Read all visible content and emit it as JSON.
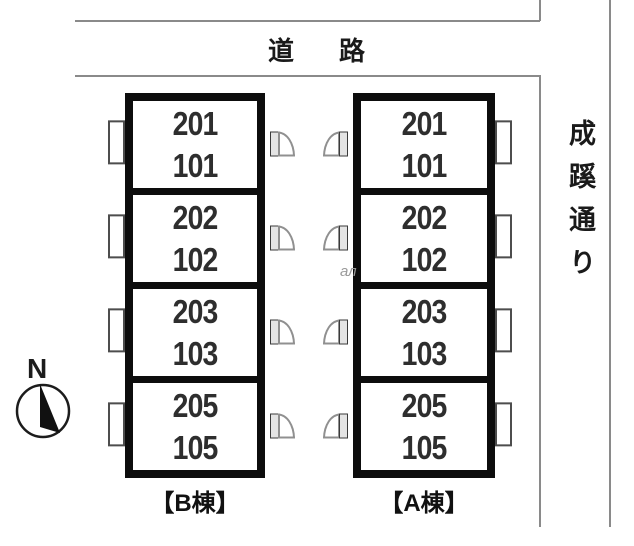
{
  "road": {
    "label": "道路"
  },
  "street": {
    "label": "成蹊通り"
  },
  "compass": {
    "label": "N"
  },
  "watermark": {
    "text": "ал"
  },
  "buildings": [
    {
      "id": "B",
      "label": "【B棟】",
      "door_side": "right",
      "units": [
        {
          "upper": "201",
          "lower": "101"
        },
        {
          "upper": "202",
          "lower": "102"
        },
        {
          "upper": "203",
          "lower": "103"
        },
        {
          "upper": "205",
          "lower": "105"
        }
      ]
    },
    {
      "id": "A",
      "label": "【A棟】",
      "door_side": "left",
      "units": [
        {
          "upper": "201",
          "lower": "101"
        },
        {
          "upper": "202",
          "lower": "102"
        },
        {
          "upper": "203",
          "lower": "103"
        },
        {
          "upper": "205",
          "lower": "105"
        }
      ]
    }
  ],
  "colors": {
    "wall": "#0d0d0d",
    "boundary_line": "#8a8a8a",
    "text": "#1a1a1a",
    "unit_number": "#2e2e2e",
    "background": "#ffffff"
  }
}
